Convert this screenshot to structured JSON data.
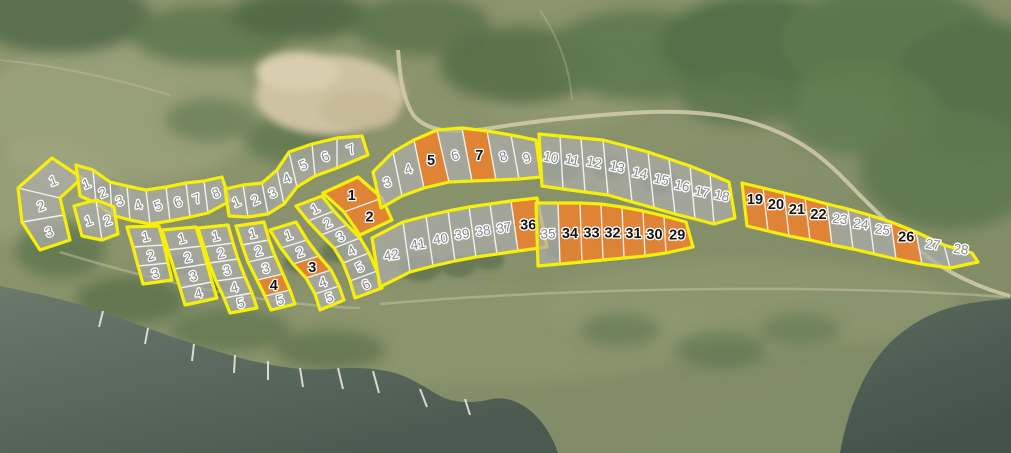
{
  "map": {
    "name": "aerial-parcel-map",
    "styles": {
      "cluster_stroke": "#f6ef0a",
      "divider_stroke": "rgba(255,255,255,0.85)",
      "parcel_fill": "rgba(173,173,170,0.72)",
      "highlight_fill": "rgba(228,132,52,0.95)",
      "label_color": "#86888c",
      "highlight_label_color": "#151515",
      "water_color": "#55645a",
      "forest_color": "#57704d",
      "sand_color": "#cdc2a2",
      "road_color": "#d2cbae"
    },
    "clusters": [
      {
        "id": "west-fan",
        "lrot": -20,
        "top": [
          [
            52,
            158
          ],
          [
            18,
            188
          ],
          [
            22,
            222
          ],
          [
            40,
            250
          ]
        ],
        "bottom": [
          [
            82,
            178
          ],
          [
            60,
            198
          ],
          [
            64,
            215
          ],
          [
            70,
            240
          ]
        ],
        "parcels": [
          {
            "n": "1"
          },
          {
            "n": "2"
          },
          {
            "n": "3"
          }
        ]
      },
      {
        "id": "shore-strip-1-8",
        "lrot": -22,
        "top": [
          [
            76,
            165
          ],
          [
            93,
            170
          ],
          [
            110,
            182
          ],
          [
            127,
            186
          ],
          [
            146,
            190
          ],
          [
            166,
            187
          ],
          [
            186,
            183
          ],
          [
            204,
            181
          ],
          [
            222,
            177
          ]
        ],
        "bottom": [
          [
            80,
            196
          ],
          [
            96,
            203
          ],
          [
            112,
            215
          ],
          [
            130,
            220
          ],
          [
            150,
            224
          ],
          [
            170,
            221
          ],
          [
            190,
            217
          ],
          [
            208,
            213
          ],
          [
            230,
            201
          ]
        ],
        "parcels": [
          {
            "n": "1"
          },
          {
            "n": "2"
          },
          {
            "n": "3"
          },
          {
            "n": "4"
          },
          {
            "n": "5"
          },
          {
            "n": "6"
          },
          {
            "n": "7"
          },
          {
            "n": "8"
          }
        ]
      },
      {
        "id": "west-pair",
        "lrot": -18,
        "top": [
          [
            74,
            206
          ],
          [
            96,
            200
          ],
          [
            114,
            207
          ]
        ],
        "bottom": [
          [
            82,
            236
          ],
          [
            102,
            240
          ],
          [
            118,
            234
          ]
        ],
        "parcels": [
          {
            "n": "1"
          },
          {
            "n": "2"
          }
        ]
      },
      {
        "id": "col-strip-1",
        "lrot": -14,
        "top": [
          [
            127,
            227
          ],
          [
            133,
            247
          ],
          [
            138,
            266
          ],
          [
            143,
            284
          ]
        ],
        "bottom": [
          [
            159,
            226
          ],
          [
            164,
            245
          ],
          [
            168,
            263
          ],
          [
            172,
            280
          ]
        ],
        "parcels": [
          {
            "n": "1"
          },
          {
            "n": "2"
          },
          {
            "n": "3"
          }
        ]
      },
      {
        "id": "col-strip-2",
        "lrot": -14,
        "top": [
          [
            162,
            230
          ],
          [
            168,
            250
          ],
          [
            174,
            269
          ],
          [
            180,
            288
          ],
          [
            185,
            305
          ]
        ],
        "bottom": [
          [
            196,
            227
          ],
          [
            202,
            246
          ],
          [
            207,
            264
          ],
          [
            212,
            282
          ],
          [
            217,
            298
          ]
        ],
        "parcels": [
          {
            "n": "1"
          },
          {
            "n": "2"
          },
          {
            "n": "3"
          },
          {
            "n": "4"
          }
        ]
      },
      {
        "id": "col-strip-3",
        "lrot": -14,
        "top": [
          [
            198,
            228
          ],
          [
            204,
            247
          ],
          [
            209,
            263
          ],
          [
            216,
            281
          ],
          [
            224,
            298
          ],
          [
            230,
            313
          ]
        ],
        "bottom": [
          [
            228,
            225
          ],
          [
            233,
            243
          ],
          [
            238,
            259
          ],
          [
            245,
            277
          ],
          [
            252,
            293
          ],
          [
            257,
            308
          ]
        ],
        "parcels": [
          {
            "n": "1"
          },
          {
            "n": "2"
          },
          {
            "n": "3"
          },
          {
            "n": "4"
          },
          {
            "n": "5"
          }
        ]
      },
      {
        "id": "col-strip-4",
        "lrot": -14,
        "top": [
          [
            236,
            226
          ],
          [
            242,
            245
          ],
          [
            248,
            262
          ],
          [
            257,
            280
          ],
          [
            265,
            296
          ],
          [
            271,
            310
          ]
        ],
        "bottom": [
          [
            264,
            222
          ],
          [
            269,
            240
          ],
          [
            275,
            256
          ],
          [
            283,
            274
          ],
          [
            290,
            290
          ],
          [
            295,
            304
          ]
        ],
        "parcels": [
          {
            "n": "1"
          },
          {
            "n": "2"
          },
          {
            "n": "3"
          },
          {
            "n": "4",
            "hl": true
          },
          {
            "n": "5"
          }
        ]
      },
      {
        "id": "col-strip-5",
        "lrot": -18,
        "top": [
          [
            270,
            230
          ],
          [
            281,
            248
          ],
          [
            293,
            264
          ],
          [
            306,
            278
          ],
          [
            315,
            294
          ],
          [
            320,
            310
          ]
        ],
        "bottom": [
          [
            296,
            222
          ],
          [
            307,
            240
          ],
          [
            319,
            256
          ],
          [
            331,
            270
          ],
          [
            339,
            286
          ],
          [
            344,
            300
          ]
        ],
        "parcels": [
          {
            "n": "1"
          },
          {
            "n": "2"
          },
          {
            "n": "3",
            "hl": true
          },
          {
            "n": "4"
          },
          {
            "n": "5"
          }
        ]
      },
      {
        "id": "diag-strip-1-6",
        "lrot": -28,
        "top": [
          [
            296,
            206
          ],
          [
            308,
            221
          ],
          [
            321,
            235
          ],
          [
            334,
            248
          ],
          [
            343,
            263
          ],
          [
            350,
            281
          ],
          [
            355,
            298
          ]
        ],
        "bottom": [
          [
            322,
            196
          ],
          [
            334,
            211
          ],
          [
            347,
            225
          ],
          [
            360,
            238
          ],
          [
            369,
            253
          ],
          [
            377,
            271
          ],
          [
            382,
            288
          ]
        ],
        "parcels": [
          {
            "n": "1"
          },
          {
            "n": "2"
          },
          {
            "n": "3"
          },
          {
            "n": "4"
          },
          {
            "n": "5"
          },
          {
            "n": "6"
          }
        ]
      },
      {
        "id": "mid-fan-1-7",
        "lrot": -24,
        "top": [
          [
            225,
            189
          ],
          [
            243,
            185
          ],
          [
            262,
            183
          ],
          [
            277,
            170
          ],
          [
            289,
            152
          ],
          [
            312,
            144
          ],
          [
            337,
            138
          ],
          [
            362,
            136
          ]
        ],
        "bottom": [
          [
            229,
            216
          ],
          [
            248,
            217
          ],
          [
            268,
            214
          ],
          [
            284,
            204
          ],
          [
            297,
            187
          ],
          [
            315,
            176
          ],
          [
            337,
            168
          ],
          [
            368,
            155
          ]
        ],
        "parcels": [
          {
            "n": "1"
          },
          {
            "n": "2"
          },
          {
            "n": "3"
          },
          {
            "n": "4"
          },
          {
            "n": "5"
          },
          {
            "n": "6"
          },
          {
            "n": "7"
          }
        ]
      },
      {
        "id": "highlight-pair-1-2",
        "lrot": 0,
        "top": [
          [
            323,
            193
          ],
          [
            344,
            212
          ],
          [
            360,
            235
          ]
        ],
        "bottom": [
          [
            358,
            177
          ],
          [
            382,
            198
          ],
          [
            392,
            220
          ]
        ],
        "parcels": [
          {
            "n": "1",
            "hl": true
          },
          {
            "n": "2",
            "hl": true
          }
        ]
      },
      {
        "id": "upper-strip-3-9",
        "lrot": -18,
        "top": [
          [
            373,
            172
          ],
          [
            393,
            152
          ],
          [
            414,
            140
          ],
          [
            437,
            130
          ],
          [
            462,
            128
          ],
          [
            487,
            131
          ],
          [
            511,
            135
          ],
          [
            536,
            140
          ]
        ],
        "bottom": [
          [
            381,
            208
          ],
          [
            402,
            196
          ],
          [
            424,
            188
          ],
          [
            449,
            182
          ],
          [
            472,
            181
          ],
          [
            496,
            180
          ],
          [
            519,
            179
          ],
          [
            541,
            177
          ]
        ],
        "parcels": [
          {
            "n": "3"
          },
          {
            "n": "4"
          },
          {
            "n": "5",
            "hl": true
          },
          {
            "n": "6"
          },
          {
            "n": "7",
            "hl": true
          },
          {
            "n": "8"
          },
          {
            "n": "9"
          }
        ]
      },
      {
        "id": "strip-36-42",
        "lrot": -8,
        "top": [
          [
            372,
            238
          ],
          [
            403,
            222
          ],
          [
            426,
            216
          ],
          [
            448,
            211
          ],
          [
            469,
            207
          ],
          [
            490,
            204
          ],
          [
            511,
            201
          ],
          [
            537,
            198
          ]
        ],
        "bottom": [
          [
            380,
            287
          ],
          [
            410,
            272
          ],
          [
            433,
            266
          ],
          [
            455,
            261
          ],
          [
            476,
            257
          ],
          [
            497,
            254
          ],
          [
            518,
            251
          ],
          [
            547,
            247
          ]
        ],
        "parcels": [
          {
            "n": "42"
          },
          {
            "n": "41"
          },
          {
            "n": "40"
          },
          {
            "n": "39"
          },
          {
            "n": "38"
          },
          {
            "n": "37"
          },
          {
            "n": "36",
            "hl": true
          }
        ]
      },
      {
        "id": "strip-29-35",
        "lrot": 0,
        "top": [
          [
            536,
            203
          ],
          [
            558,
            203
          ],
          [
            580,
            203
          ],
          [
            601,
            204
          ],
          [
            622,
            207
          ],
          [
            643,
            211
          ],
          [
            664,
            216
          ],
          [
            686,
            222
          ]
        ],
        "bottom": [
          [
            538,
            266
          ],
          [
            560,
            264
          ],
          [
            582,
            262
          ],
          [
            603,
            260
          ],
          [
            624,
            258
          ],
          [
            645,
            256
          ],
          [
            666,
            253
          ],
          [
            693,
            247
          ]
        ],
        "parcels": [
          {
            "n": "35"
          },
          {
            "n": "34",
            "hl": true
          },
          {
            "n": "33",
            "hl": true
          },
          {
            "n": "32",
            "hl": true
          },
          {
            "n": "31",
            "hl": true
          },
          {
            "n": "30",
            "hl": true
          },
          {
            "n": "29",
            "hl": true
          }
        ]
      },
      {
        "id": "strip-10-18",
        "lrot": 12,
        "ldy": -4,
        "top": [
          [
            539,
            134
          ],
          [
            560,
            136
          ],
          [
            581,
            138
          ],
          [
            603,
            140
          ],
          [
            626,
            146
          ],
          [
            648,
            152
          ],
          [
            669,
            159
          ],
          [
            690,
            166
          ],
          [
            710,
            174
          ],
          [
            729,
            182
          ]
        ],
        "bottom": [
          [
            542,
            186
          ],
          [
            563,
            189
          ],
          [
            585,
            192
          ],
          [
            608,
            195
          ],
          [
            632,
            202
          ],
          [
            654,
            208
          ],
          [
            675,
            214
          ],
          [
            695,
            219
          ],
          [
            714,
            224
          ],
          [
            735,
            218
          ]
        ],
        "parcels": [
          {
            "n": "10"
          },
          {
            "n": "11"
          },
          {
            "n": "12"
          },
          {
            "n": "13"
          },
          {
            "n": "14"
          },
          {
            "n": "15"
          },
          {
            "n": "16"
          },
          {
            "n": "17"
          },
          {
            "n": "18"
          }
        ]
      },
      {
        "id": "strip-19-28",
        "lrot": 8,
        "ldy": -8,
        "top": [
          [
            742,
            183
          ],
          [
            763,
            188
          ],
          [
            784,
            193
          ],
          [
            805,
            198
          ],
          [
            827,
            204
          ],
          [
            848,
            209
          ],
          [
            869,
            215
          ],
          [
            891,
            222
          ],
          [
            916,
            232
          ],
          [
            944,
            245
          ],
          [
            972,
            253
          ]
        ],
        "bottom": [
          [
            747,
            226
          ],
          [
            768,
            231
          ],
          [
            789,
            236
          ],
          [
            810,
            240
          ],
          [
            832,
            245
          ],
          [
            853,
            249
          ],
          [
            874,
            254
          ],
          [
            896,
            259
          ],
          [
            922,
            264
          ],
          [
            950,
            268
          ],
          [
            978,
            262
          ]
        ],
        "parcels": [
          {
            "n": "19",
            "hl": true
          },
          {
            "n": "20",
            "hl": true
          },
          {
            "n": "21",
            "hl": true
          },
          {
            "n": "22",
            "hl": true
          },
          {
            "n": "23"
          },
          {
            "n": "24"
          },
          {
            "n": "25"
          },
          {
            "n": "26",
            "hl": true
          },
          {
            "n": "27"
          },
          {
            "n": "28"
          }
        ]
      }
    ]
  }
}
